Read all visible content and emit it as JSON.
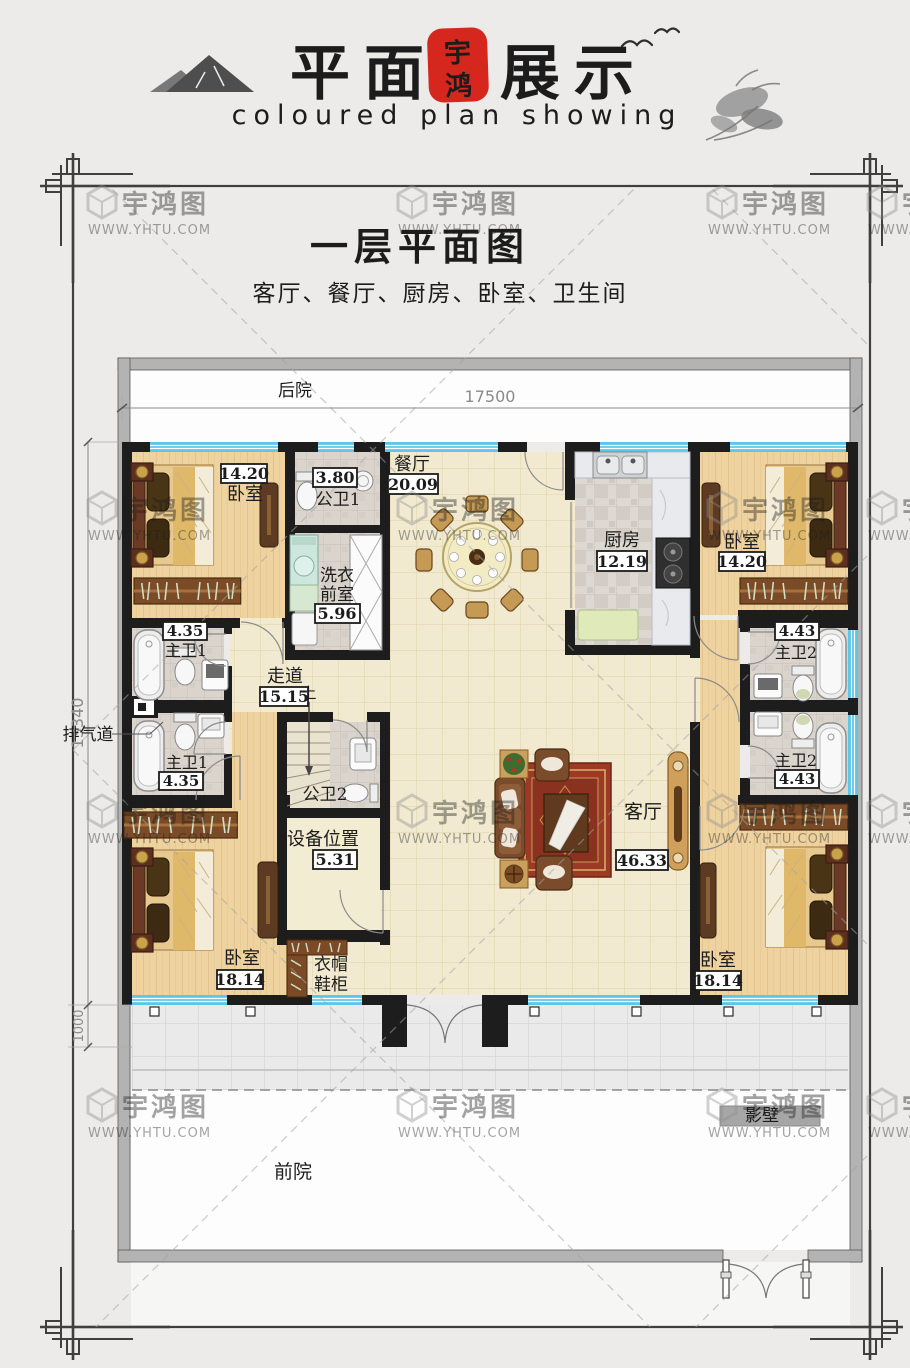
{
  "header": {
    "brand_left": "平面",
    "brand_right": "展示",
    "seal_top": "宇",
    "seal_bottom": "鸿",
    "tagline": "coloured plan showing",
    "accent_red": "#c23128",
    "seal_red": "#d6271e"
  },
  "plan": {
    "title": "一层平面图",
    "summary": "客厅、餐厅、厨房、卧室、卫生间"
  },
  "dims": {
    "width": "17500",
    "height": "13340",
    "porch": "1000"
  },
  "site": {
    "backyard": "后院",
    "frontyard": "前院",
    "screen_wall": "影壁",
    "exhaust_duct": "排气道",
    "stairs_up": "上"
  },
  "rooms": {
    "bedroom_tl": {
      "name": "卧室",
      "area": "14.20"
    },
    "bedroom_tr": {
      "name": "卧室",
      "area": "14.20"
    },
    "bedroom_bl": {
      "name": "卧室",
      "area": "18.14"
    },
    "bedroom_br": {
      "name": "卧室",
      "area": "18.14"
    },
    "public_bath_1": {
      "name": "公卫1",
      "area": "3.80"
    },
    "public_bath_2": {
      "name": "公卫2"
    },
    "laundry": {
      "name_line1": "洗衣",
      "name_line2": "前室",
      "area": "5.96"
    },
    "dining": {
      "name": "餐厅",
      "area": "20.09"
    },
    "kitchen": {
      "name": "厨房",
      "area": "12.19"
    },
    "master_bath_1a": {
      "name": "主卫1",
      "area": "4.35"
    },
    "master_bath_1b": {
      "name": "主卫1",
      "area": "4.35"
    },
    "master_bath_2a": {
      "name": "主卫2",
      "area": "4.43"
    },
    "master_bath_2b": {
      "name": "主卫2",
      "area": "4.43"
    },
    "hallway": {
      "name": "走道",
      "area": "15.15"
    },
    "equipment": {
      "name": "设备位置",
      "area": "5.31"
    },
    "living": {
      "name": "客厅",
      "area": "46.33"
    },
    "cloakroom": {
      "name_line1": "衣帽",
      "name_line2": "鞋柜"
    }
  },
  "watermark": {
    "name": "宇鸿图",
    "url": "WWW.YHTU.COM"
  },
  "colors": {
    "window_blue": "#5ec7e9",
    "wall_black": "#1d1d1d",
    "yard_wall_gray": "#b3b3b3"
  }
}
